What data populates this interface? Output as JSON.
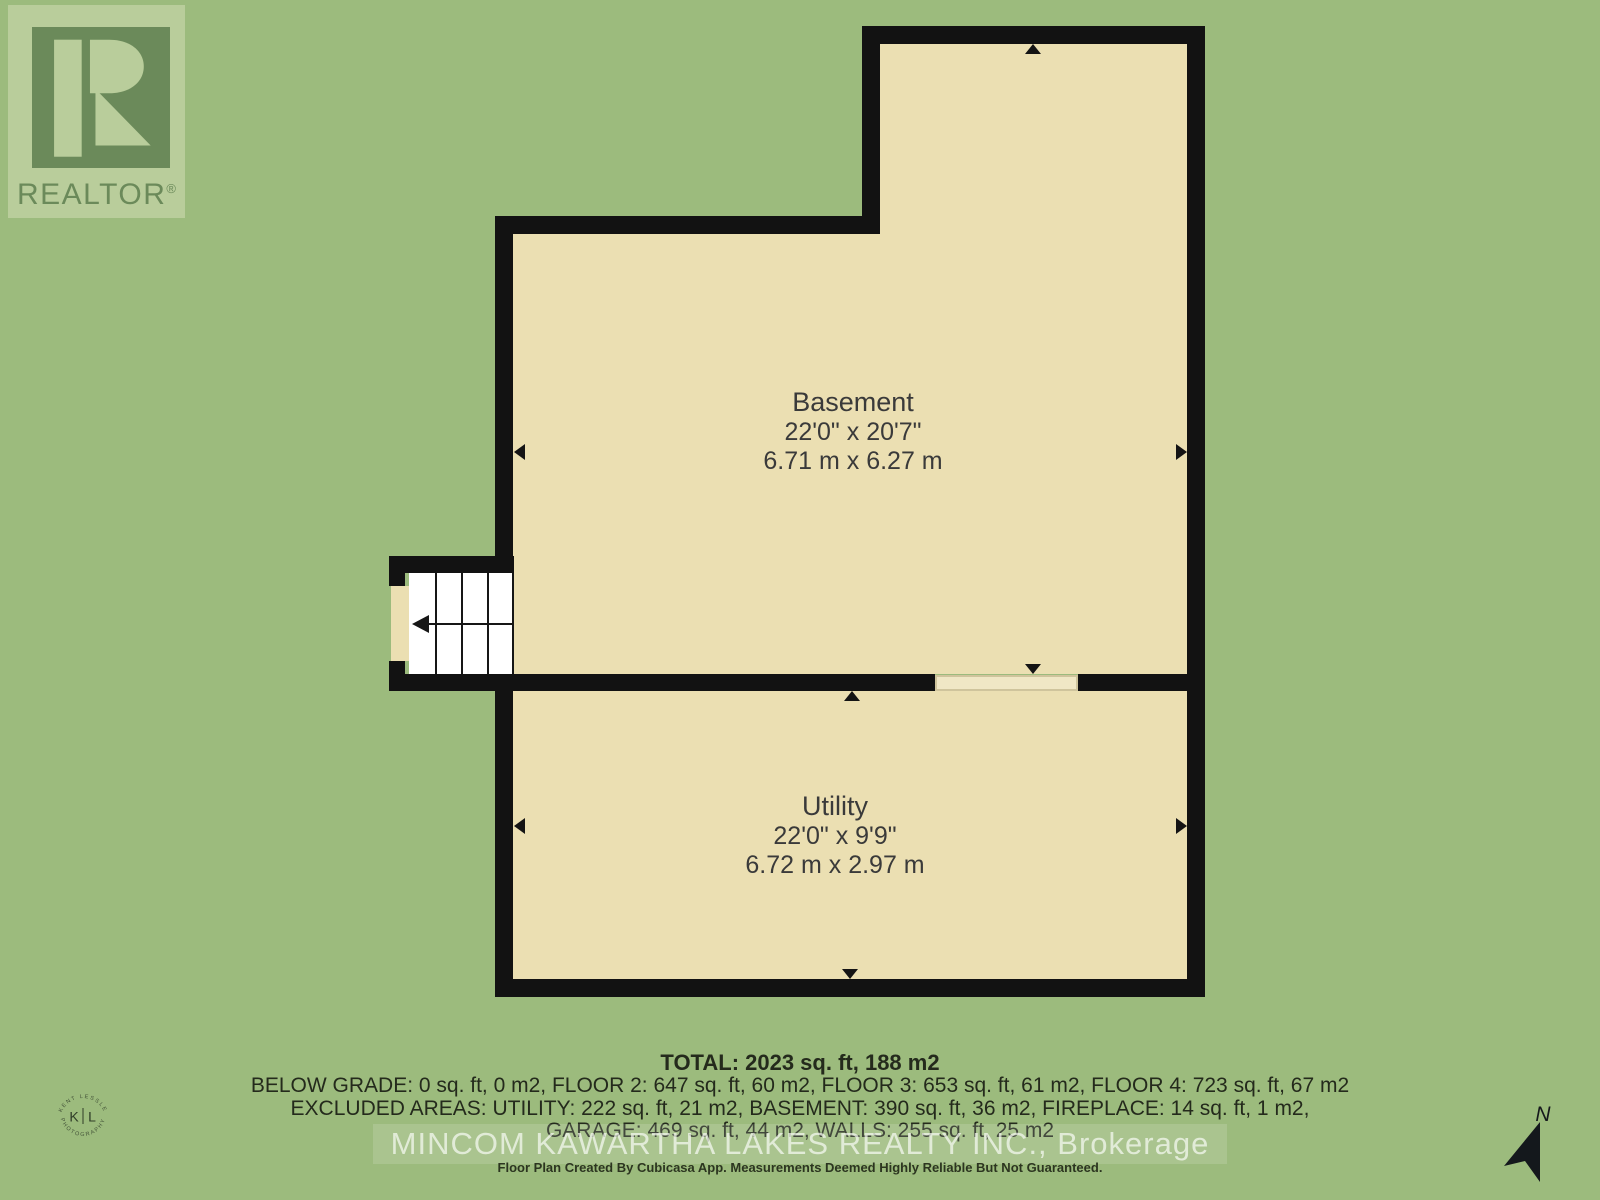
{
  "branding": {
    "realtor_text": "REALTOR",
    "reg": "®"
  },
  "rooms": [
    {
      "name": "Basement",
      "dimensions_imperial": "22'0\" x 20'7\"",
      "dimensions_metric": "6.71 m x 6.27 m"
    },
    {
      "name": "Utility",
      "dimensions_imperial": "22'0\" x 9'9\"",
      "dimensions_metric": "6.72 m x 2.97 m"
    }
  ],
  "summary": {
    "total": "TOTAL: 2023 sq. ft, 188 m2",
    "below_grade_line": "BELOW GRADE: 0 sq. ft, 0 m2, FLOOR 2: 647 sq. ft, 60 m2, FLOOR 3: 653 sq. ft, 61 m2, FLOOR 4: 723 sq. ft, 67 m2",
    "excluded_line1": "EXCLUDED AREAS: UTILITY: 222 sq. ft, 21 m2, BASEMENT: 390 sq. ft, 36 m2, FIREPLACE: 14 sq. ft, 1 m2,",
    "excluded_line2": "GARAGE: 469 sq. ft, 44 m2, WALLS: 255 sq. ft, 25 m2"
  },
  "watermark": "MINCOM KAWARTHA LAKES REALTY INC., Brokerage",
  "disclaimer": "Floor Plan Created By Cubicasa App. Measurements Deemed Highly Reliable But Not Guaranteed.",
  "compass": {
    "label": "N"
  },
  "photographer_badge": {
    "top_arc": "KENT LESSLE",
    "bottom_arc": "PHOTOGRAPHY",
    "left_initial": "K",
    "right_initial": "L"
  },
  "colors": {
    "background_green": "#9cbb7d",
    "floor_cream": "#ebdfb2",
    "wall_black": "#121212",
    "stairs_white": "#ffffff",
    "logo_light_green": "#b9cd9b",
    "logo_dark_green": "#6b8a5a",
    "label_text": "#3a3a3a"
  }
}
